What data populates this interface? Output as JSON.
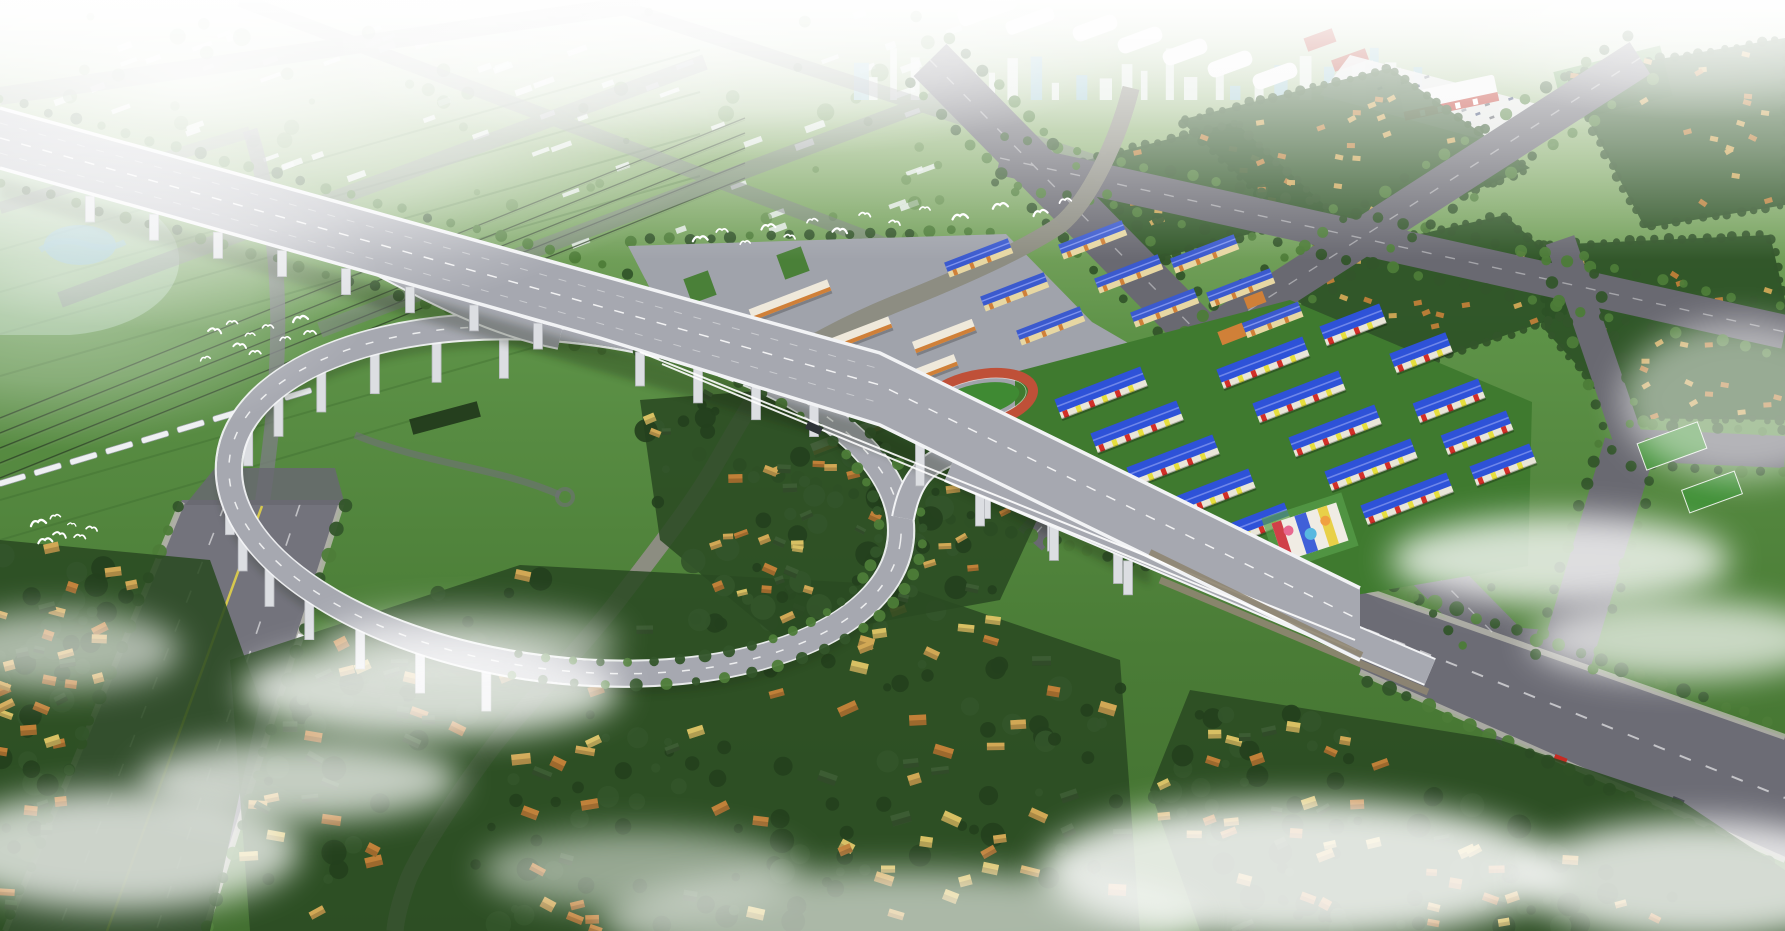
{
  "meta": {
    "description": "Aerial architectural rendering of an urban plan: elevated expressway with loop interchange ramp over villages, school campus with running track, rows of blue-roofed housing, winding canal, railway with white train, bird flocks, haze and ground mist."
  },
  "palette": {
    "sky0": "#edf2ea",
    "sky1": "#8fb274",
    "field": "#5d9247",
    "field2": "#4a7c36",
    "field3": "#426f30",
    "blockgreen": "#2d5126",
    "villagegreen": "#2a4a22",
    "treedark": "#24401d",
    "treemid": "#33552a",
    "treelite": "#4d7c38",
    "road": "#696971",
    "roadlite": "#7d7d86",
    "sidewalk": "#b9b9ae",
    "deck": "#a6a8b0",
    "decklane": "#8f919b",
    "barrier": "#f2f3f5",
    "pier": "#dcdee2",
    "wall": "#8f8672",
    "river": "#3c7ccc",
    "riverlite": "#85b5ea",
    "bank": "#8d8d82",
    "pond": "#7fb8d8",
    "plaza": "#a0a3ab",
    "planter": "#4a8038",
    "trackred": "#bf5038",
    "trackgreen": "#3f8a33",
    "pitch": "#3f8f35",
    "schoolwhite": "#efe9db",
    "schoolorange": "#d08038",
    "aptroof": "#3b5ace",
    "aptwall": "#e7d7a3",
    "estroof": "#2e52d8",
    "estred": "#d22f28",
    "estyellow": "#e6df3e",
    "estwhite": "#e9e6d8",
    "estlawn": "#3f7a2f",
    "vr1": "#c08038",
    "vr2": "#d1a855",
    "vr3": "#d8c063",
    "vrg": "#3c5c33",
    "whroof": "#f7f7f7",
    "brick": "#b7483a",
    "parking": "#e9e9ea",
    "mallred": "#c03a30",
    "citywhite": "#e9efec",
    "cityglass": "#9fc9d8",
    "yellowline": "#d6c84e",
    "train": "#eef0f2",
    "rail": "#2f4229",
    "mist": "#ffffff",
    "shadow": "#14240e"
  },
  "corridors": {
    "artery": {
      "r": 52,
      "pts": [
        [
          0,
          138
        ],
        [
          220,
          200
        ],
        [
          440,
          262
        ],
        [
          660,
          318
        ],
        [
          880,
          385
        ],
        [
          1060,
          473
        ],
        [
          1240,
          562
        ],
        [
          1360,
          630
        ]
      ]
    },
    "seg3": {
      "r": 100,
      "pts": [
        [
          1360,
          630
        ],
        [
          1500,
          705
        ],
        [
          1640,
          770
        ],
        [
          1785,
          835
        ]
      ]
    },
    "aveG": {
      "r": 92,
      "pts": [
        [
          262,
          505
        ],
        [
          230,
          600
        ],
        [
          195,
          700
        ],
        [
          160,
          800
        ],
        [
          125,
          900
        ],
        [
          107,
          931
        ]
      ]
    },
    "river": {
      "r": 24,
      "pts": [
        [
          1131,
          88
        ],
        [
          1108,
          160
        ],
        [
          1060,
          225
        ],
        [
          990,
          265
        ],
        [
          900,
          302
        ],
        [
          820,
          338
        ],
        [
          778,
          368
        ],
        [
          748,
          412
        ],
        [
          712,
          470
        ],
        [
          668,
          535
        ],
        [
          622,
          595
        ],
        [
          560,
          665
        ],
        [
          498,
          740
        ],
        [
          448,
          812
        ],
        [
          408,
          880
        ],
        [
          395,
          931
        ]
      ]
    },
    "aveB": {
      "r": 30,
      "pts": [
        [
          930,
          60
        ],
        [
          1072,
          205
        ],
        [
          1214,
          350
        ],
        [
          1356,
          495
        ],
        [
          1500,
          640
        ]
      ]
    },
    "roadH": {
      "r": 22,
      "pts": [
        [
          1218,
          330
        ],
        [
          1124,
          435
        ],
        [
          1030,
          540
        ]
      ]
    },
    "aveD": {
      "r": 24,
      "pts": [
        [
          1640,
          58
        ],
        [
          1430,
          194
        ],
        [
          1218,
          330
        ]
      ]
    },
    "aveE": {
      "r": 22,
      "pts": [
        [
          1000,
          158
        ],
        [
          1392,
          245
        ],
        [
          1785,
          332
        ]
      ]
    },
    "aveC": {
      "r": 28,
      "pts": [
        [
          1565,
          662
        ],
        [
          1630,
          445
        ],
        [
          1785,
          452
        ],
        [
          1630,
          445
        ],
        [
          1560,
          240
        ]
      ]
    }
  },
  "villages": [
    {
      "name": "village-bottom-center",
      "poly": [
        [
          230,
          660
        ],
        [
          520,
          565
        ],
        [
          900,
          585
        ],
        [
          1120,
          660
        ],
        [
          1140,
          931
        ],
        [
          250,
          931
        ]
      ],
      "houses": 95,
      "size": [
        15,
        9
      ],
      "trees": 130,
      "avoid": [
        "aveG",
        "river",
        "artery",
        "seg3"
      ]
    },
    {
      "name": "village-loop-inner",
      "poly": [
        [
          640,
          400
        ],
        [
          900,
          380
        ],
        [
          1060,
          470
        ],
        [
          1000,
          600
        ],
        [
          780,
          640
        ],
        [
          660,
          540
        ]
      ],
      "houses": 40,
      "size": [
        11,
        7
      ],
      "trees": 60,
      "avoid": [
        "river",
        "artery"
      ]
    },
    {
      "name": "village-bottom-right",
      "poly": [
        [
          1190,
          690
        ],
        [
          1500,
          740
        ],
        [
          1680,
          800
        ],
        [
          1785,
          870
        ],
        [
          1785,
          931
        ],
        [
          1200,
          931
        ],
        [
          1150,
          790
        ]
      ],
      "houses": 45,
      "size": [
        13,
        8
      ],
      "trees": 70,
      "avoid": [
        "seg3"
      ]
    },
    {
      "name": "village-left-strip",
      "poly": [
        [
          0,
          540
        ],
        [
          210,
          560
        ],
        [
          260,
          700
        ],
        [
          210,
          931
        ],
        [
          0,
          931
        ]
      ],
      "houses": 34,
      "size": [
        13,
        8
      ],
      "trees": 40,
      "avoid": [
        "aveG"
      ]
    }
  ],
  "blocks": [
    {
      "name": "block-ne-1",
      "poly": [
        [
          1180,
          120
        ],
        [
          1390,
          68
        ],
        [
          1530,
          168
        ],
        [
          1320,
          252
        ]
      ],
      "houses": 26
    },
    {
      "name": "block-ne-2",
      "poly": [
        [
          1565,
          75
        ],
        [
          1785,
          38
        ],
        [
          1785,
          205
        ],
        [
          1645,
          228
        ]
      ],
      "houses": 20
    },
    {
      "name": "block-e-3",
      "poly": [
        [
          1545,
          245
        ],
        [
          1770,
          235
        ],
        [
          1785,
          300
        ],
        [
          1785,
          420
        ],
        [
          1625,
          418
        ],
        [
          1545,
          330
        ]
      ],
      "houses": 30
    },
    {
      "name": "block-ne-4",
      "poly": [
        [
          1295,
          262
        ],
        [
          1505,
          215
        ],
        [
          1602,
          302
        ],
        [
          1428,
          362
        ],
        [
          1305,
          330
        ]
      ],
      "houses": 20
    },
    {
      "name": "block-ne-5",
      "poly": [
        [
          1040,
          172
        ],
        [
          1235,
          122
        ],
        [
          1332,
          212
        ],
        [
          1122,
          268
        ]
      ],
      "houses": 16
    }
  ],
  "tree_rows": [
    {
      "pts": [
        [
          909,
          81
        ],
        [
          1479,
          661
        ]
      ],
      "sp": 22,
      "r": 5
    },
    {
      "pts": [
        [
          951,
          39
        ],
        [
          1521,
          619
        ]
      ],
      "sp": 22,
      "r": 5
    },
    {
      "pts": [
        [
          995,
          181
        ],
        [
          1780,
          355
        ]
      ],
      "sp": 24,
      "r": 5
    },
    {
      "pts": [
        [
          1005,
          135
        ],
        [
          1790,
          309
        ]
      ],
      "sp": 24,
      "r": 5
    },
    {
      "pts": [
        [
          1626,
          36
        ],
        [
          1204,
          308
        ]
      ],
      "sp": 24,
      "r": 5
    },
    {
      "pts": [
        [
          1654,
          80
        ],
        [
          1232,
          352
        ]
      ],
      "sp": 24,
      "r": 5
    },
    {
      "pts": [
        [
          1594,
          671
        ],
        [
          1659,
          454
        ]
      ],
      "sp": 22,
      "r": 5
    },
    {
      "pts": [
        [
          1536,
          653
        ],
        [
          1601,
          436
        ]
      ],
      "sp": 22,
      "r": 5
    },
    {
      "pts": [
        [
          1630,
          425
        ],
        [
          1785,
          432
        ]
      ],
      "sp": 22,
      "r": 5
    },
    {
      "pts": [
        [
          1630,
          465
        ],
        [
          1785,
          472
        ]
      ],
      "sp": 22,
      "r": 5
    },
    {
      "pts": [
        [
          1650,
          442
        ],
        [
          1580,
          237
        ]
      ],
      "sp": 22,
      "r": 5
    },
    {
      "pts": [
        [
          1610,
          448
        ],
        [
          1540,
          243
        ]
      ],
      "sp": 22,
      "r": 5
    },
    {
      "pts": [
        [
          1201,
          315
        ],
        [
          1013,
          525
        ]
      ],
      "sp": 22,
      "r": 5
    },
    {
      "pts": [
        [
          1234,
          345
        ],
        [
          1046,
          555
        ]
      ],
      "sp": 22,
      "r": 5
    },
    {
      "pts": [
        [
          180,
          505
        ],
        [
          3,
          931
        ]
      ],
      "sp": 26,
      "r": 6
    },
    {
      "pts": [
        [
          344,
          505
        ],
        [
          207,
          931
        ]
      ],
      "sp": 26,
      "r": 6
    },
    {
      "pts": [
        [
          1372,
          580
        ],
        [
          1785,
          727
        ]
      ],
      "sp": 22,
      "r": 6
    },
    {
      "pts": [
        [
          1368,
          680
        ],
        [
          1785,
          868
        ]
      ],
      "sp": 22,
      "r": 6
    },
    {
      "pts": [
        [
          0,
          98
        ],
        [
          870,
          340
        ]
      ],
      "sp": 26,
      "r": 5
    },
    {
      "pts": [
        [
          0,
          182
        ],
        [
          620,
          356
        ]
      ],
      "sp": 26,
      "r": 5
    },
    {
      "pts": [
        [
          630,
          240
        ],
        [
          1008,
          230
        ]
      ],
      "sp": 20,
      "r": 5
    },
    {
      "pts": [
        [
          700,
          455
        ],
        [
          1180,
          575
        ]
      ],
      "sp": 20,
      "r": 6
    }
  ],
  "buildings": {
    "schools": {
      "h": 12,
      "rot": -21,
      "items": [
        [
          838,
          342,
          112
        ],
        [
          898,
          382,
          124
        ],
        [
          858,
          432,
          98
        ],
        [
          944,
          336,
          64
        ],
        [
          790,
          300,
          84
        ]
      ]
    },
    "apartments": {
      "h": 12,
      "rot": -21,
      "items": [
        [
          978,
          256,
          68
        ],
        [
          1014,
          290,
          68
        ],
        [
          1050,
          324,
          68
        ],
        [
          1092,
          238,
          68
        ],
        [
          1128,
          272,
          68
        ],
        [
          1164,
          306,
          68
        ],
        [
          1204,
          252,
          68
        ],
        [
          1240,
          286,
          68
        ],
        [
          1272,
          318,
          60
        ]
      ]
    },
    "estate": {
      "h": 15,
      "rot": -21,
      "items": [
        [
          1100,
          390,
          92
        ],
        [
          1136,
          424,
          92
        ],
        [
          1172,
          458,
          92
        ],
        [
          1208,
          492,
          92
        ],
        [
          1244,
          526,
          92
        ],
        [
          1262,
          360,
          92
        ],
        [
          1298,
          394,
          92
        ],
        [
          1334,
          428,
          92
        ],
        [
          1370,
          462,
          92
        ],
        [
          1406,
          496,
          92
        ],
        [
          1448,
          398,
          70
        ],
        [
          1476,
          430,
          70
        ],
        [
          1502,
          462,
          64
        ],
        [
          1352,
          322,
          64
        ],
        [
          1420,
          350,
          60
        ]
      ]
    }
  },
  "loop": {
    "cx": 565,
    "cy": 500,
    "rx": 338,
    "ry": 170,
    "rot": 7,
    "piers": {
      "a0": 100,
      "a1": 262,
      "step": 12,
      "len": 44
    },
    "trees": {
      "a0": -80,
      "a1": 98,
      "step": 5,
      "off": 22,
      "r": 5
    }
  },
  "artery_piers": [
    {
      "x0": 90,
      "x1": 580,
      "y0": 196,
      "y1": 335,
      "step": 64,
      "len": 26
    },
    {
      "x0": 640,
      "x1": 860,
      "y0": 352,
      "y1": 416,
      "step": 58,
      "len": 34
    },
    {
      "x0": 920,
      "x1": 1180,
      "y0": 444,
      "y1": 572,
      "step": 66,
      "len": 42
    },
    {
      "x0": 980,
      "x1": 1180,
      "y0": 492,
      "y1": 585,
      "step": 74,
      "len": 34
    }
  ],
  "rails": {
    "x0": 0,
    "y0": 418,
    "x1": 745,
    "y1": 118,
    "lines": 5,
    "gap": 15
  },
  "train": {
    "x0": 12,
    "y0": 480,
    "x1": 298,
    "y1": 394,
    "cars": 9
  },
  "city_blocks": {
    "x": 30,
    "y": 0,
    "w": 920,
    "h": 300,
    "count": 110,
    "greens": 70
  },
  "skyline": {
    "x0": 840,
    "x1": 1430,
    "count": 26
  },
  "parking_cars": {
    "x0": 1368,
    "y0": 62,
    "cols": 13,
    "rows": 4,
    "dx": 14,
    "dy": 13,
    "skew": 0.35
  },
  "birds": {
    "flocks": [
      [
        [
          215,
          330
        ],
        [
          232,
          322
        ],
        [
          250,
          334
        ],
        [
          268,
          326
        ],
        [
          285,
          338
        ],
        [
          300,
          318
        ],
        [
          255,
          352
        ],
        [
          240,
          345
        ],
        [
          310,
          332
        ],
        [
          205,
          358
        ]
      ],
      [
        [
          38,
          522
        ],
        [
          55,
          516
        ],
        [
          72,
          524
        ],
        [
          60,
          534
        ],
        [
          45,
          540
        ],
        [
          80,
          536
        ],
        [
          92,
          528
        ]
      ],
      [
        [
          700,
          238
        ],
        [
          722,
          230
        ],
        [
          745,
          242
        ],
        [
          768,
          226
        ],
        [
          790,
          236
        ],
        [
          812,
          220
        ],
        [
          840,
          230
        ],
        [
          865,
          214
        ],
        [
          895,
          222
        ],
        [
          925,
          208
        ],
        [
          960,
          216
        ],
        [
          1000,
          205
        ],
        [
          1040,
          212
        ],
        [
          1065,
          200
        ]
      ]
    ]
  },
  "mist_blobs": [
    [
      430,
      690,
      190,
      48,
      0.8
    ],
    [
      300,
      780,
      160,
      40,
      0.72
    ],
    [
      120,
      850,
      180,
      60,
      0.75
    ],
    [
      640,
      870,
      160,
      40,
      0.5
    ],
    [
      1560,
      560,
      170,
      45,
      0.78
    ],
    [
      1680,
      640,
      150,
      40,
      0.7
    ],
    [
      1300,
      870,
      260,
      70,
      0.85
    ],
    [
      1700,
      880,
      180,
      60,
      0.8
    ],
    [
      900,
      920,
      300,
      50,
      0.6
    ],
    [
      60,
      650,
      120,
      40,
      0.6
    ],
    [
      1740,
      400,
      120,
      80,
      0.5
    ],
    [
      470,
      640,
      150,
      30,
      0.55
    ]
  ]
}
